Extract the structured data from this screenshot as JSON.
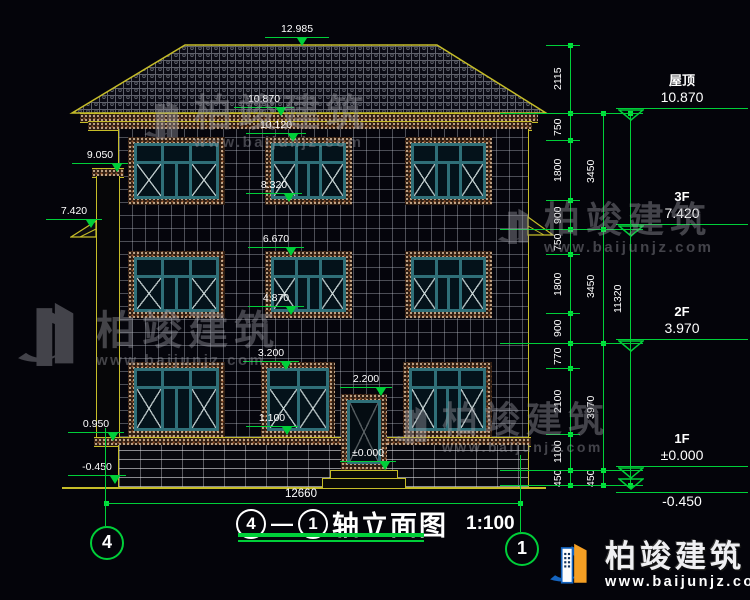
{
  "colors": {
    "background": "#04040a",
    "dim_green": "#00cf39",
    "outline_yellow": "#c6bd28",
    "window_teal": "#2f6f78",
    "text_white": "#ffffff"
  },
  "markers": {
    "ridge": "12.985",
    "eave": "10.870",
    "w3f_top": "10.120",
    "pilaster_top": "9.050",
    "w3f_sill": "8.320",
    "left_3f": "7.420",
    "w2f_top": "6.670",
    "w2f_sill": "4.870",
    "w1f_top": "3.200",
    "door_top": "2.200",
    "w1f_sill": "1.100",
    "belt": "0.950",
    "ground_left": "-0.450",
    "door_bottom": "±0.000"
  },
  "right_levels": [
    {
      "name": "屋顶",
      "elev": "10.870"
    },
    {
      "name": "3F",
      "elev": "7.420"
    },
    {
      "name": "2F",
      "elev": "3.970"
    },
    {
      "name": "1F",
      "elev": "±0.000"
    },
    {
      "name": "",
      "elev": "-0.450"
    }
  ],
  "dim_chains": {
    "inner": [
      "2115",
      "750",
      "1800",
      "900",
      "750",
      "1800",
      "900",
      "770",
      "2100",
      "1100",
      "450"
    ],
    "middle": [
      "3450",
      "3450",
      "3970",
      "450"
    ],
    "outer": [
      "11320"
    ]
  },
  "bottom_dim": "12660",
  "axis_bubbles": {
    "left": "4",
    "right": "1"
  },
  "title_block": {
    "axis_from": "4",
    "separator": "—",
    "axis_to": "1",
    "name": "轴立面图",
    "scale": "1:100"
  },
  "watermark": {
    "brand": "柏竣建筑",
    "url": "www.baijunjz.com"
  }
}
